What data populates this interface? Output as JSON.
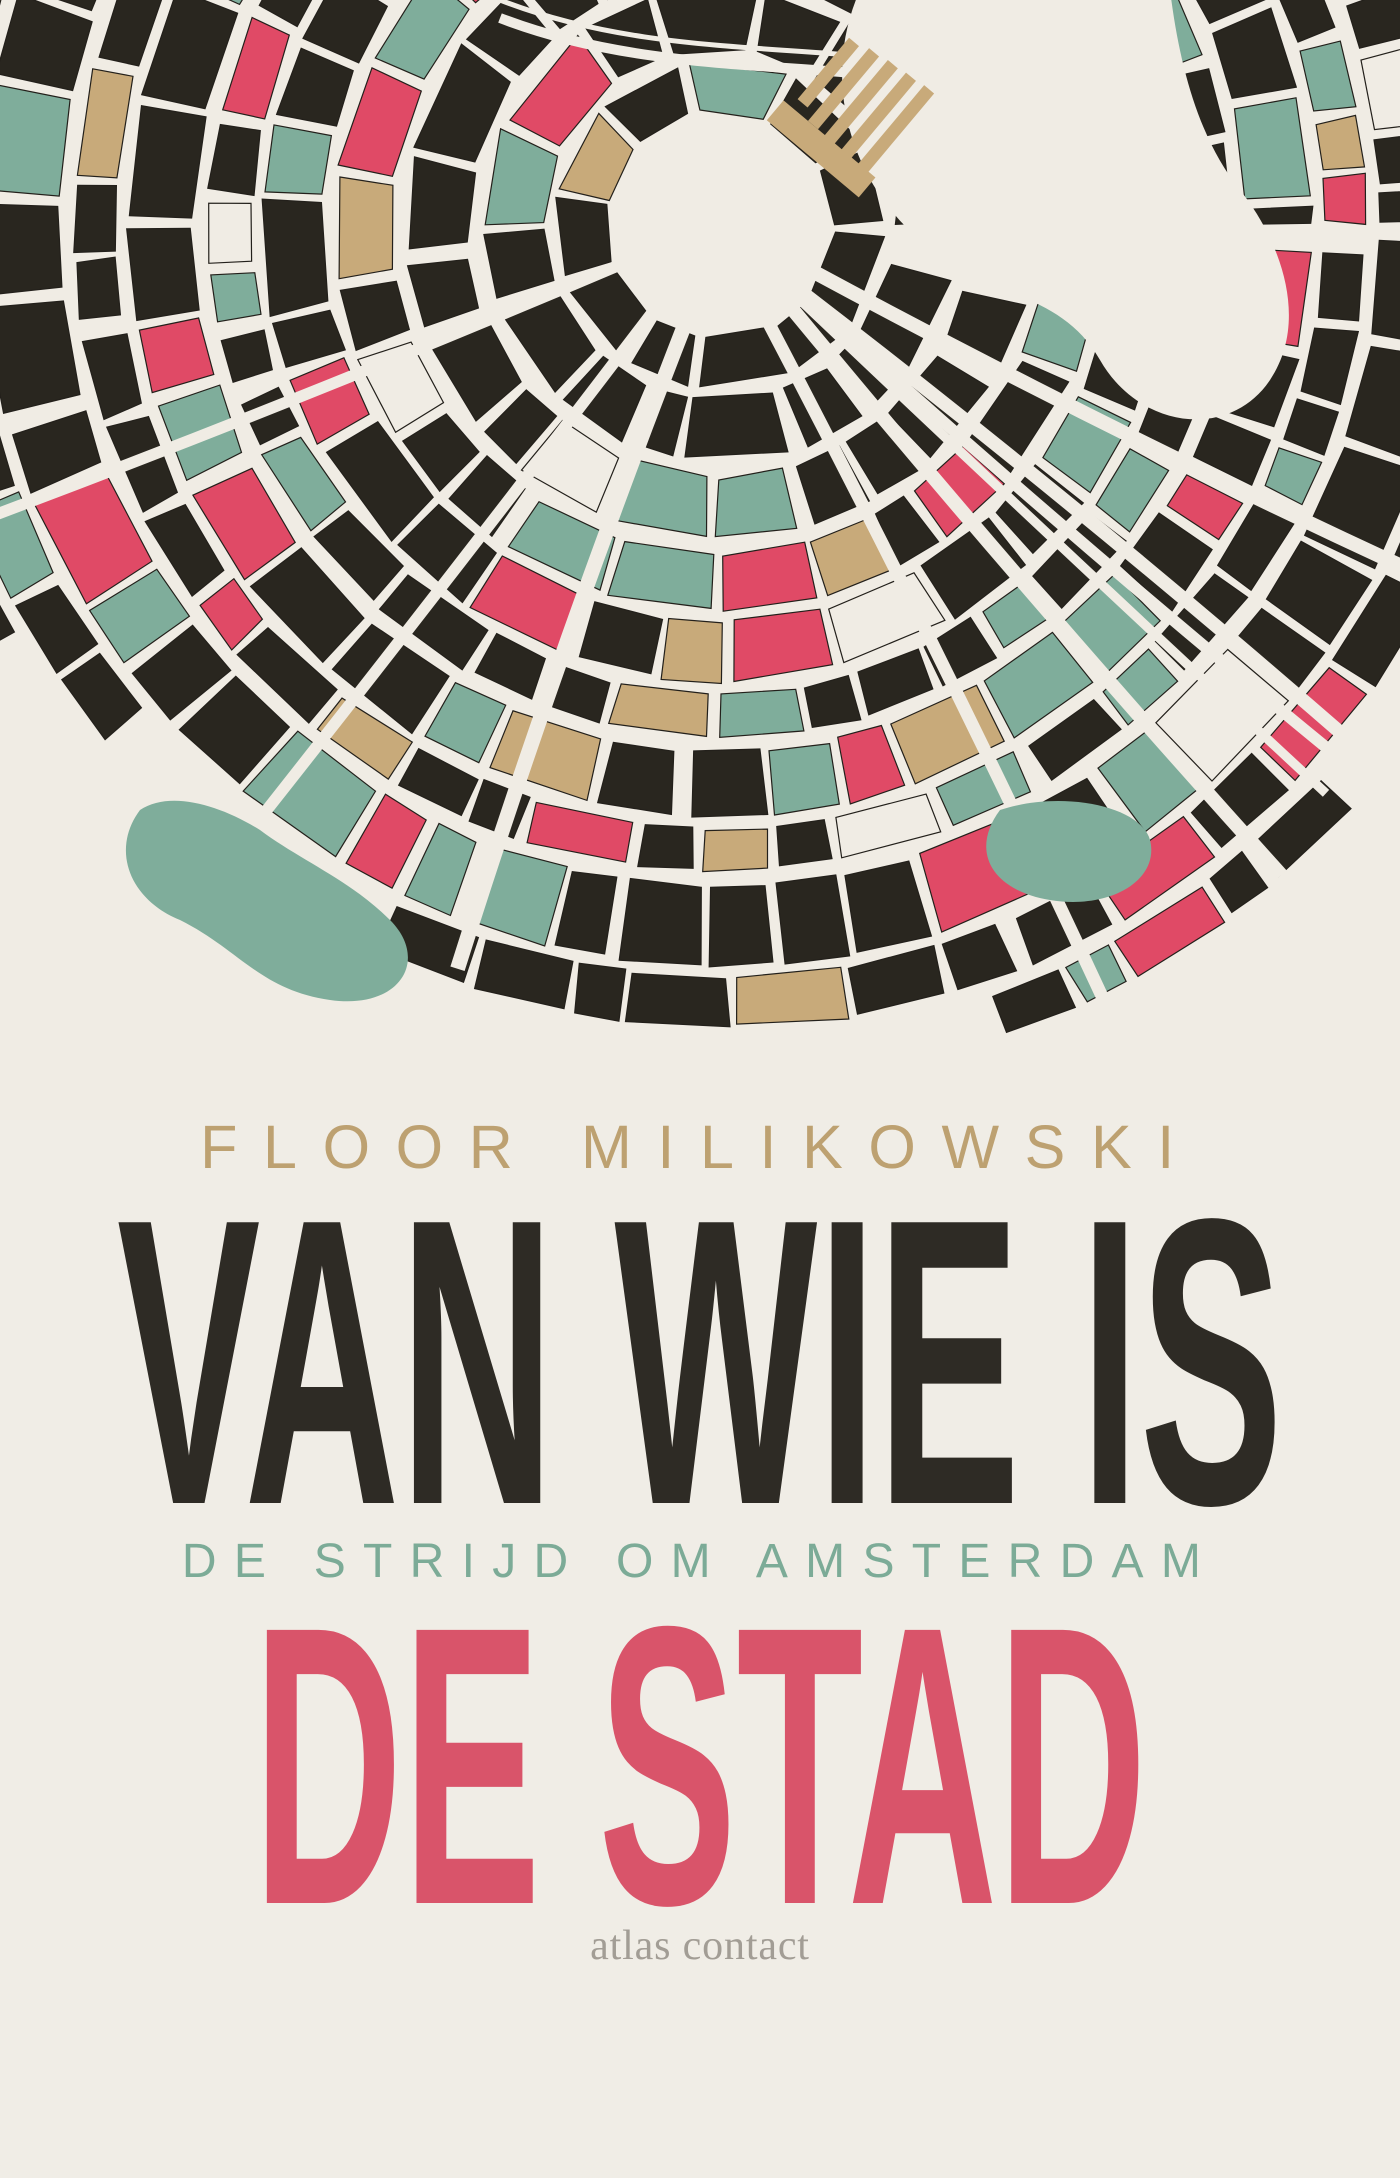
{
  "cover": {
    "author": "FLOOR MILIKOWSKI",
    "title_line1": "VAN WIE IS",
    "subtitle": "DE STRIJD OM AMSTERDAM",
    "title_line2": "DE STAD",
    "publisher": "atlas contact"
  },
  "colors": {
    "background": "#f0ede6",
    "author_gold": "#bda171",
    "title_dark": "#2e2b25",
    "subtitle_teal": "#7cab97",
    "title_red": "#d9546a",
    "publisher_gray": "#a29d95"
  },
  "map": {
    "description": "stylized-amsterdam-city-block-map",
    "palette": {
      "street": "#f0ece4",
      "block_dark": "#29261f",
      "block_teal": "#7fad9b",
      "block_red": "#e04a66",
      "block_tan": "#c8aa7a"
    },
    "weights": {
      "block_dark": 0.54,
      "block_teal": 0.17,
      "block_red": 0.12,
      "block_tan": 0.11,
      "street": 0.06
    }
  }
}
